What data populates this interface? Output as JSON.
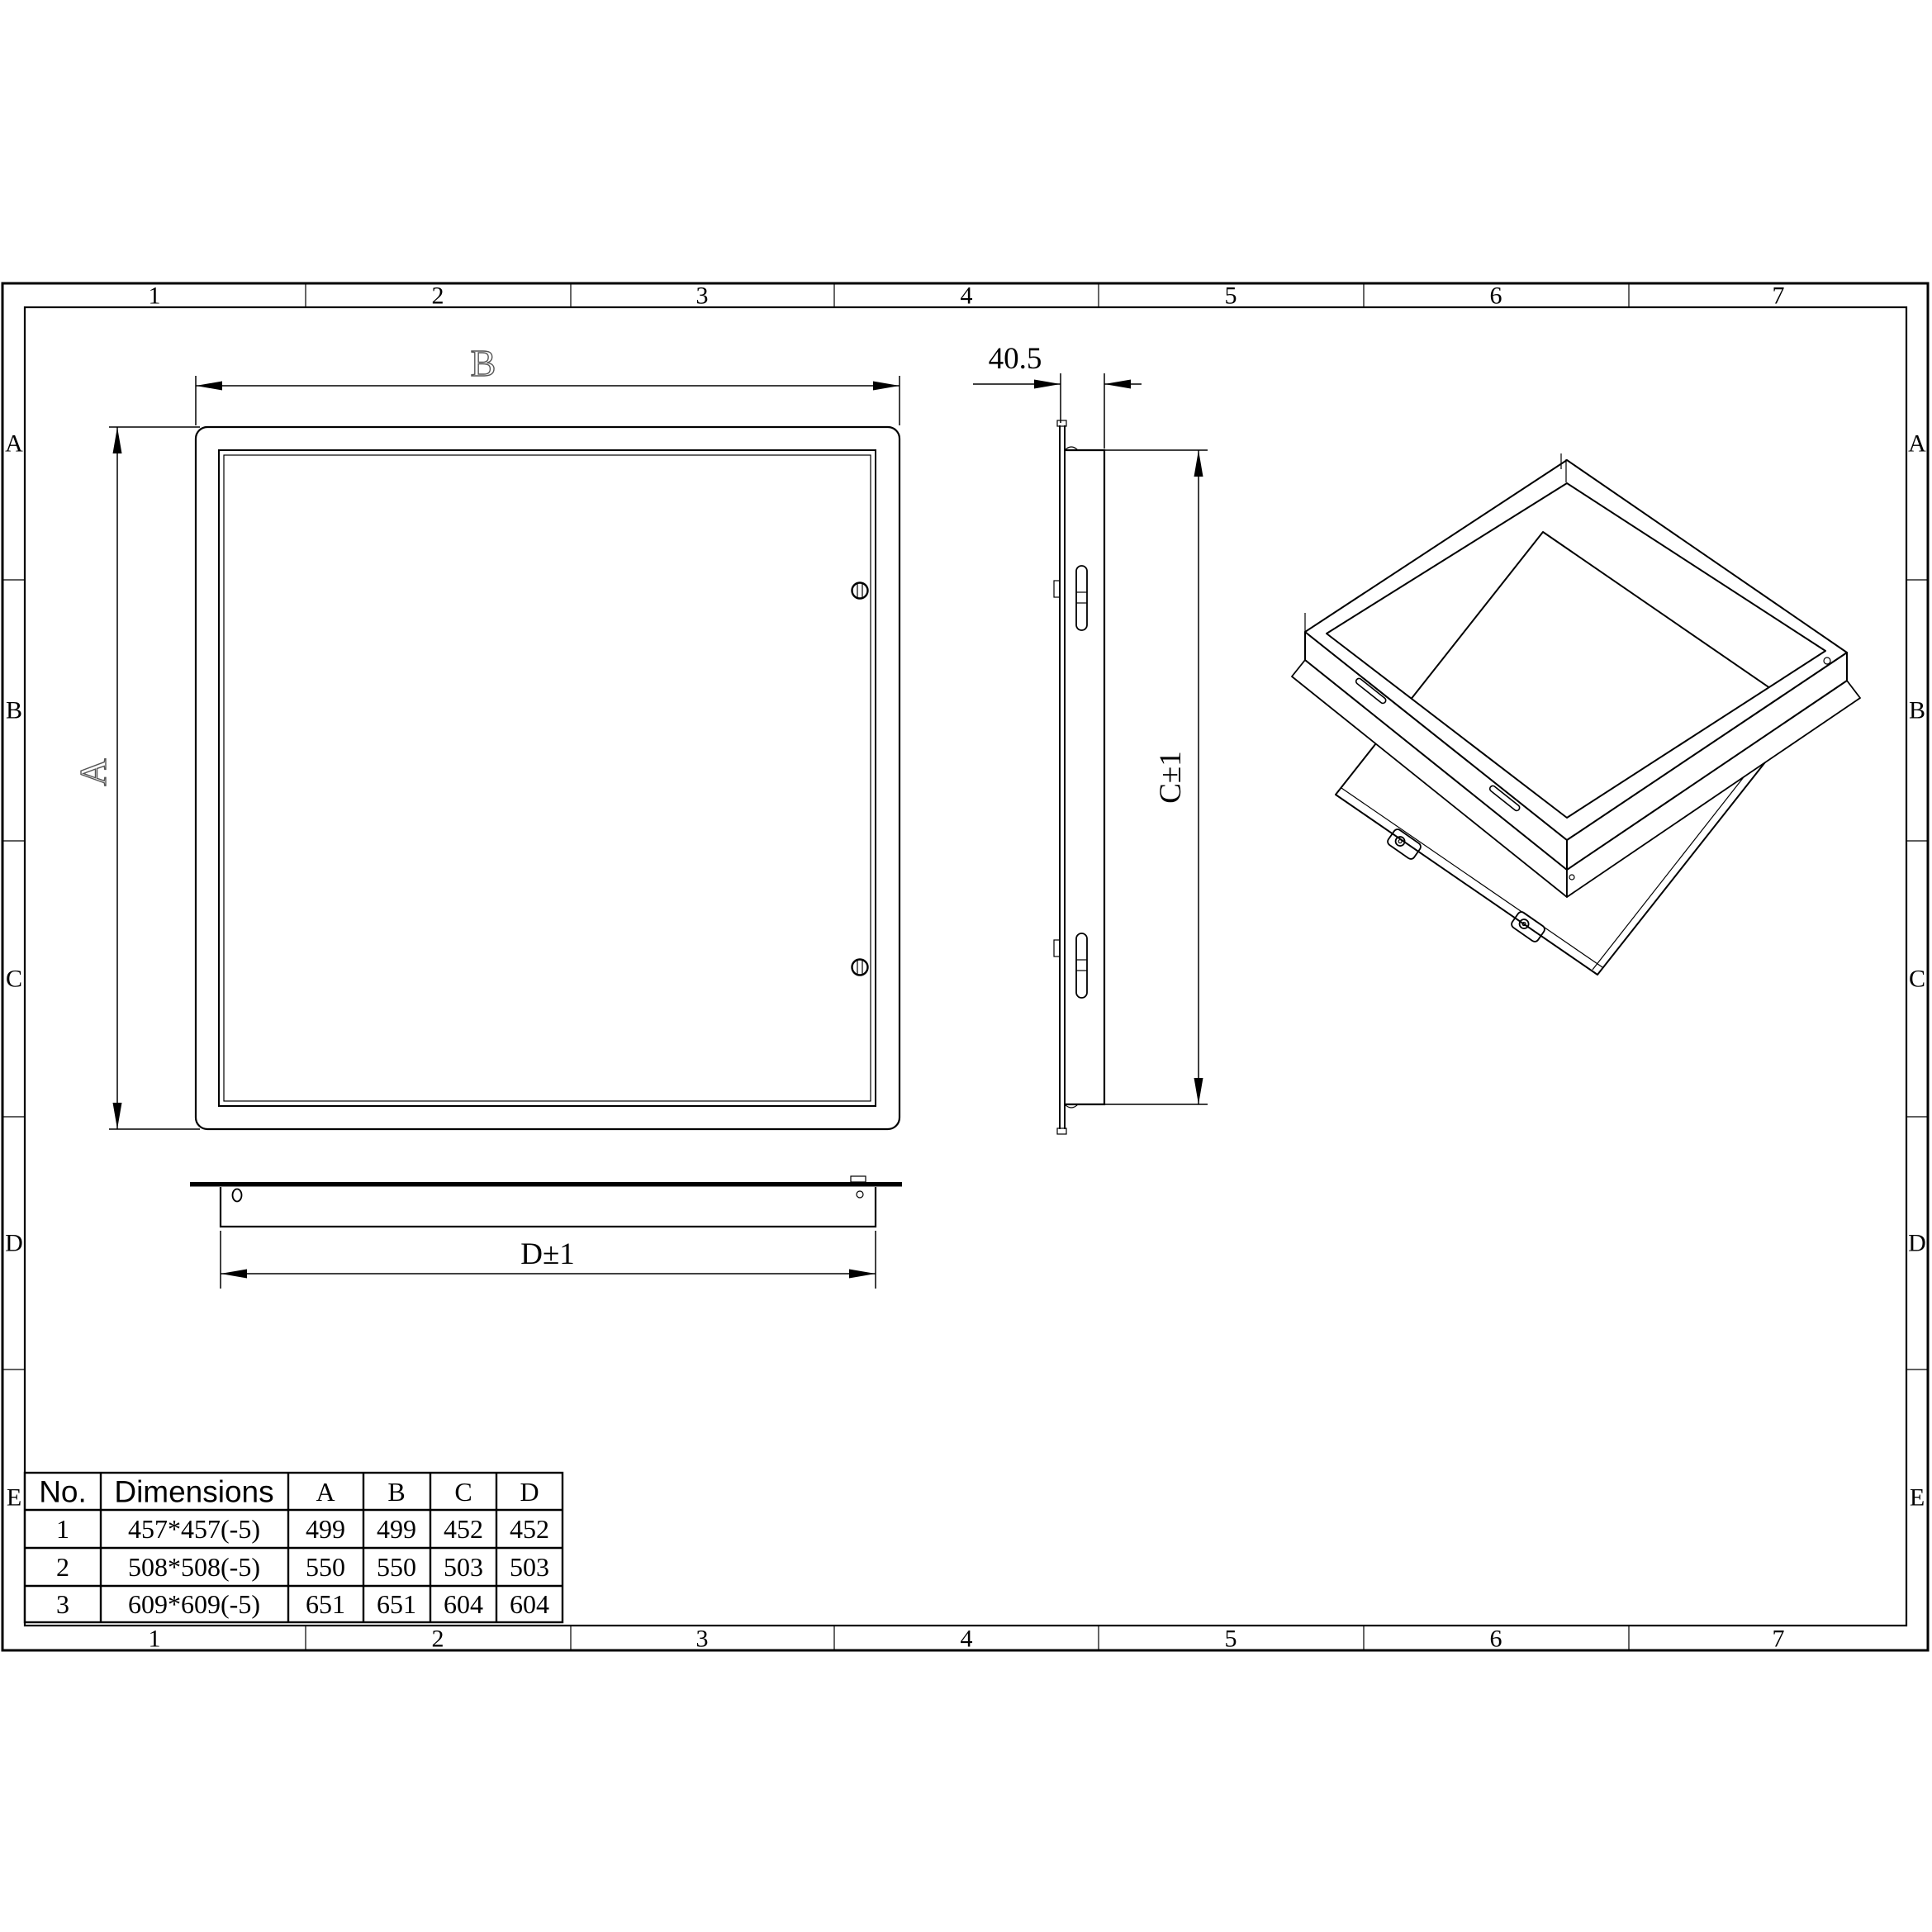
{
  "sheet": {
    "zone_columns": [
      "1",
      "2",
      "3",
      "4",
      "5",
      "6",
      "7"
    ],
    "zone_rows": [
      "A",
      "B",
      "C",
      "D",
      "E"
    ]
  },
  "views": {
    "front": {
      "width_label": "B",
      "height_label": "A"
    },
    "side": {
      "depth_label": "40.5",
      "height_label": "C±1"
    },
    "bottom": {
      "width_label": "D±1"
    }
  },
  "table": {
    "headers": [
      "No.",
      "Dimensions",
      "A",
      "B",
      "C",
      "D"
    ],
    "rows": [
      [
        "1",
        "457*457(-5)",
        "499",
        "499",
        "452",
        "452"
      ],
      [
        "2",
        "508*508(-5)",
        "550",
        "550",
        "503",
        "503"
      ],
      [
        "3",
        "609*609(-5)",
        "651",
        "651",
        "604",
        "604"
      ]
    ]
  },
  "colors": {
    "line": "#000000",
    "background": "#ffffff",
    "hollow_label": "#555555"
  }
}
